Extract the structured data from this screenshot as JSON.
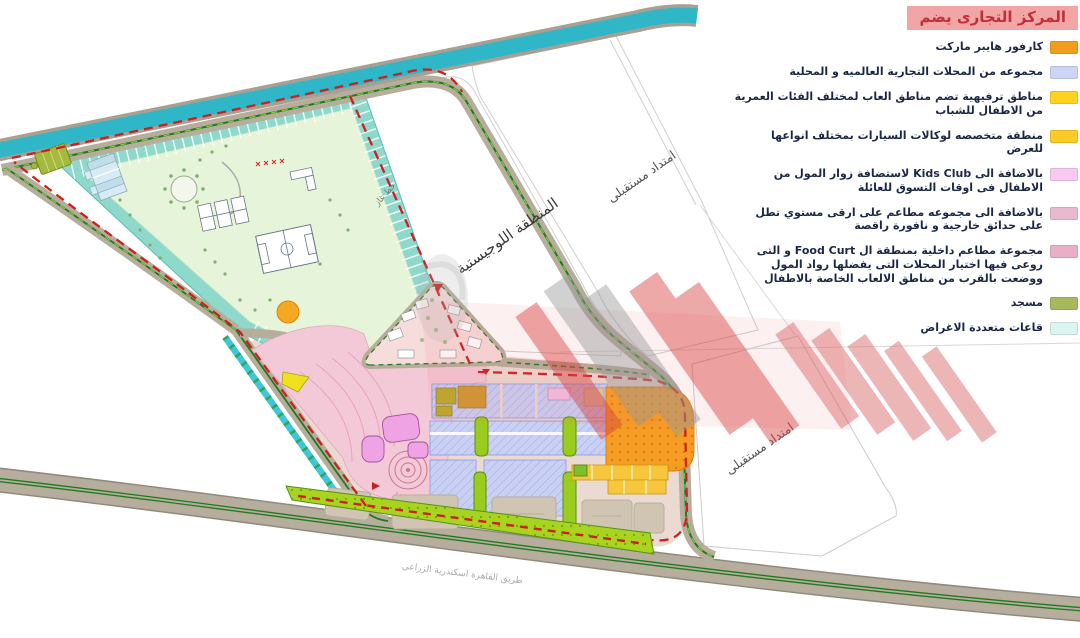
{
  "legend": {
    "title": "المركز التجارى يضم",
    "title_bg": "#F2A5A5",
    "title_color": "#C0303A",
    "items": [
      {
        "label": "كارفور هايبر ماركت",
        "color": "#F49C1C"
      },
      {
        "label": "مجموعه من المحلات التجارية العالميه و المحلية",
        "color": "#CDD5F5"
      },
      {
        "label": "مناطق ترفيهية تضم مناطق العاب لمختلف الفئات العمرية من الاطفال للشباب",
        "color": "#FFD21E"
      },
      {
        "label": "منطقة متخصصه لوكالات السيارات بمختلف انواعها للعرض",
        "color": "#FDCB25"
      },
      {
        "label": "بالاضافة الى Kids Club لاستضافة زوار المول من الاطفال فى اوقات التسوق للعائلة",
        "color": "#F9C9F0"
      },
      {
        "label": "بالاضافة الى مجموعه مطاعم على ارقى مستوي تطل على حدائق خارجية و نافورة راقصة",
        "color": "#EBB9CD"
      },
      {
        "label": "مجموعة مطاعم داخلية بمنطقة ال Food Curt و التى روعى فيها اختيار المحلات التى يفضلها رواد المول ووضعت بالقرب من مناطق الالعاب الخاصة بالاطفال",
        "color": "#E8AFC6"
      },
      {
        "label": "مسجد",
        "color": "#A4B95E"
      },
      {
        "label": "قاعات متعددة الاغراض",
        "color": "#DCF5F0"
      }
    ]
  },
  "map": {
    "labels": {
      "logistics_zone": "المنطقة اللوجيستية",
      "future_extension_top": "امتداد مستقبلى",
      "future_extension_bottom": "امتداد مستقبلى",
      "gas_line": "خط غاز",
      "highway": "طريق القاهرة اسكندرية الزراعى"
    },
    "colors": {
      "canal_teal": "#2FB7C8",
      "road_tan": "#B7AD9D",
      "median_green": "#1E7A1E",
      "boundary_red": "#CC1F1F",
      "recreation_ring": "#8ED8CC",
      "recreation_inner": "#E6F5DA"
    }
  }
}
